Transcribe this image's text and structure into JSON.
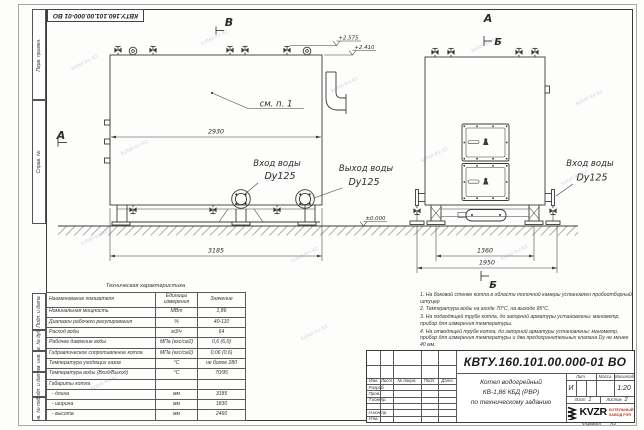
{
  "watermark": {
    "text": "kotel-kv.kz"
  },
  "sheet": {
    "top_stamp": "КВТУ.160.101.00.000-01 ВО",
    "format_label": "Формат",
    "format_value": "А3",
    "margin_labels": [
      "Перв. примен.",
      "Справ. №",
      "Подп. и дата",
      "Инв. № дубл.",
      "Взам. инв. №",
      "Подп. и дата",
      "Инв. № подл."
    ]
  },
  "drawing": {
    "marker_v": "В",
    "marker_a_left": "А",
    "marker_a_top": "А",
    "marker_b_top": "Б",
    "marker_b_bottom": "Б",
    "see_note": "см. п. 1",
    "dims": {
      "inner_width": "2930",
      "length": "3185",
      "base_width": "1360",
      "overall_width": "1950"
    },
    "elevations": {
      "valve_top": "+2.575",
      "boiler_top": "+2.410",
      "ground": "±0.000"
    },
    "inlet_left": {
      "title": "Вход воды",
      "size": "Dy125"
    },
    "outlet_left": {
      "title": "Выход воды",
      "size": "Dy125"
    },
    "inlet_right": {
      "title": "Вход воды",
      "size": "Dy125"
    }
  },
  "tech_table": {
    "title": "Техническая характеристика",
    "headers": {
      "name": "Наименование показателя",
      "units": "Единицы измерения",
      "value": "Значение"
    },
    "rows": [
      {
        "name": "Номинальная мощность",
        "units": "МВт",
        "value": "1,86"
      },
      {
        "name": "Диапазон рабочего регулирования",
        "units": "%",
        "value": "40-110"
      },
      {
        "name": "Расход воды",
        "units": "м3/ч",
        "value": "64"
      },
      {
        "name": "Рабочее давление воды",
        "units": "МПа (кгс/см2)",
        "value": "0,6 (6,0)"
      },
      {
        "name": "Гидравлическое сопротивление котла",
        "units": "МПа (кгс/см2)",
        "value": "0,06 (0,6)"
      },
      {
        "name": "Температура уходящих газов",
        "units": "°С",
        "value": "не более 280"
      },
      {
        "name": "Температура воды (Вход/Выход)",
        "units": "°С",
        "value": "70/95"
      },
      {
        "name": "Габариты котла",
        "units": "",
        "value": ""
      },
      {
        "name": "  - длина",
        "units": "мм",
        "value": "3185"
      },
      {
        "name": "  - ширина",
        "units": "мм",
        "value": "1830"
      },
      {
        "name": "  - высота",
        "units": "мм",
        "value": "2460"
      }
    ]
  },
  "notes": {
    "items": [
      "1.  На боковой стенке котла в области топочной камеры установлен пробоотборный штуцер",
      "2.  Температура воды на входе 70°С, на выходе 95°С.",
      "3.  На подводящей трубе котла, до запорной арматуры установлены: манометр, прибор для измерения температуры.",
      "4.  На отводящей трубе котла, до запорной арматуры установлены: манометр, прибор для измерения температуры и два предохранительных клапана Dy не менее 40 мм.",
      "5.  Остальные технические требования по ОСТ 108.030.133-84."
    ]
  },
  "title_block": {
    "doc_number": "КВТУ.160.101.00.000-01 ВО",
    "header_cells": [
      "Изм.",
      "Лист",
      "№ докум.",
      "Подп.",
      "Дата"
    ],
    "left_rows": [
      "Разраб.",
      "Пров.",
      "Т.контр.",
      "",
      "Н.контр.",
      "Утв."
    ],
    "title_line1": "Котел водогрейный",
    "title_line2": "КВ-1,86 КБД (РВР)",
    "title_line3": "по техническому заданию",
    "lit_label": "Лит.",
    "lit_value": "И",
    "mass_label": "Масса",
    "scale_label": "Масштаб",
    "scale_value": "1:20",
    "sheet_label": "Лист",
    "sheet_value": "1",
    "sheets_label": "Листов",
    "sheets_value": "2",
    "company_name": "KVZR",
    "company_sub1": "КОТЕЛЬНЫЙ",
    "company_sub2": "ЗАВОД РЭП"
  }
}
